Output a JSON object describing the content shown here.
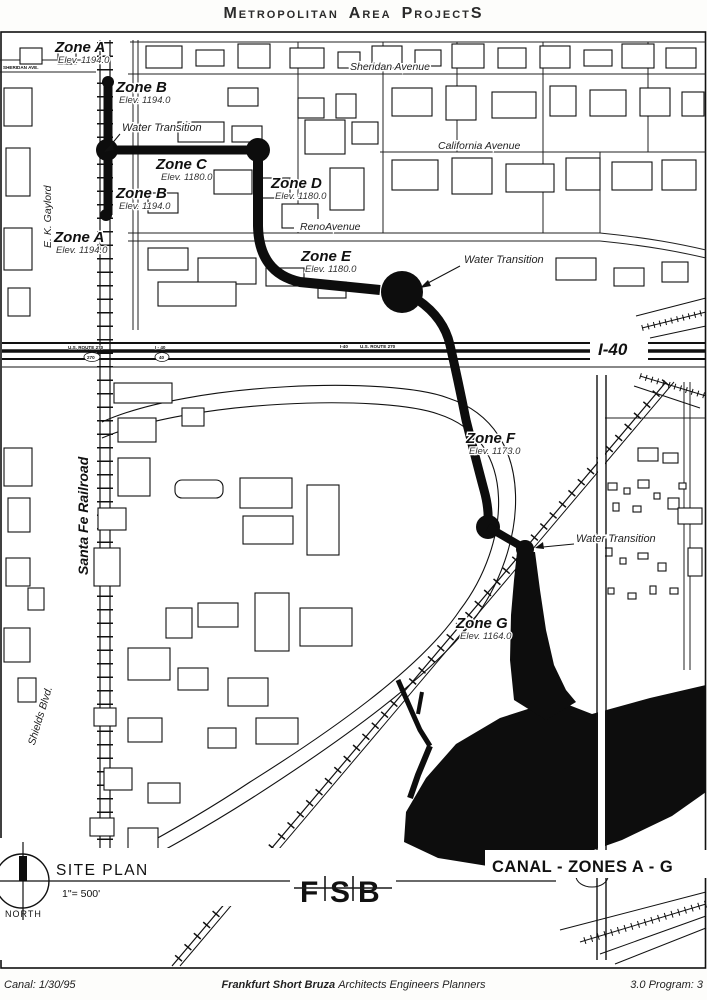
{
  "header": {
    "m_big": "M",
    "m_rest": "ETROPOLITAN",
    "a_big": "A",
    "a_rest": "REA",
    "p_big": "P",
    "p_rest": "ROJECT",
    "s_big": "S"
  },
  "zones": [
    {
      "name": "Zone A",
      "elev": "Elev. 1194.0"
    },
    {
      "name": "Zone B",
      "elev": "Elev. 1194.0"
    },
    {
      "name": "Zone C",
      "elev": "Elev. 1180.0"
    },
    {
      "name": "Zone B",
      "elev": "Elev. 1194.0"
    },
    {
      "name": "Zone D",
      "elev": "Elev. 1180.0"
    },
    {
      "name": "Zone A",
      "elev": "Elev. 1194.0"
    },
    {
      "name": "Zone E",
      "elev": "Elev. 1180.0"
    },
    {
      "name": "Zone F",
      "elev": "Elev. 1173.0"
    },
    {
      "name": "Zone G",
      "elev": "Elev. 1164.0"
    }
  ],
  "water_transitions": [
    {
      "label": "Water Transition"
    },
    {
      "label": "Water Transition"
    },
    {
      "label": "Water Transition"
    }
  ],
  "streets": {
    "sheridan_small": "SHERIDAN AVE.",
    "sheridan": "Sheridan Avenue",
    "california": "California Avenue",
    "reno": "RenoAvenue",
    "gaylord": "E. K. Gaylord",
    "santa_fe": "Santa Fe Railroad",
    "shields": "Shields Blvd.",
    "i40": "I-40",
    "route270_left": "U.S. ROUTE 270",
    "i40_tiny_left": "I - 40",
    "i40_tiny_right": "I-40",
    "route270_right": "U.S. ROUTE 270",
    "shield_270": "270",
    "shield_40": "40"
  },
  "legend": {
    "title": "SITE PLAN",
    "scale": "1\"= 500'",
    "north": "NORTH",
    "sheet_title": "CANAL - ZONES A - G",
    "logo": {
      "f": "F",
      "s": "S",
      "b": "B"
    }
  },
  "footer": {
    "left": "Canal: 1/30/95",
    "firm": "Frankfurt Short Bruza",
    "firm_rest": "Architects Engineers Planners",
    "right": "3.0 Program: 3"
  }
}
